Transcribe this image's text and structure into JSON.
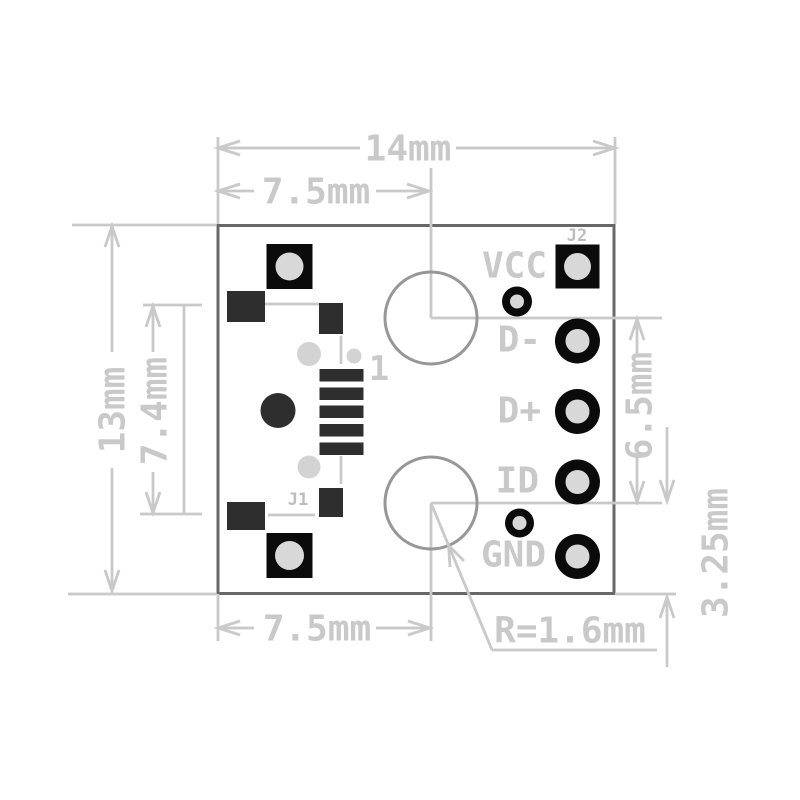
{
  "dims": {
    "total_width": "14mm",
    "top_offset": "7.5mm",
    "total_height": "13mm",
    "left_span": "7.4mm",
    "bottom_offset": "7.5mm",
    "right_span": "6.5mm",
    "bottom_right_offset": "3.25mm",
    "hole_radius": "R=1.6mm"
  },
  "labels": {
    "j1": "J1",
    "j2": "J2",
    "pin1": "1"
  },
  "pins": [
    {
      "label": "VCC"
    },
    {
      "label": "D-"
    },
    {
      "label": "D+"
    },
    {
      "label": "ID"
    },
    {
      "label": "GND"
    }
  ],
  "colors": {
    "dim": "#c9c9c9",
    "ref": "#bdbdbd",
    "outline": "#686868",
    "drill": "#979797",
    "pad": "#0b0b0b",
    "dark": "#2e2e2e",
    "hole": "#d8d8d8",
    "post": "#d3d3d3"
  }
}
